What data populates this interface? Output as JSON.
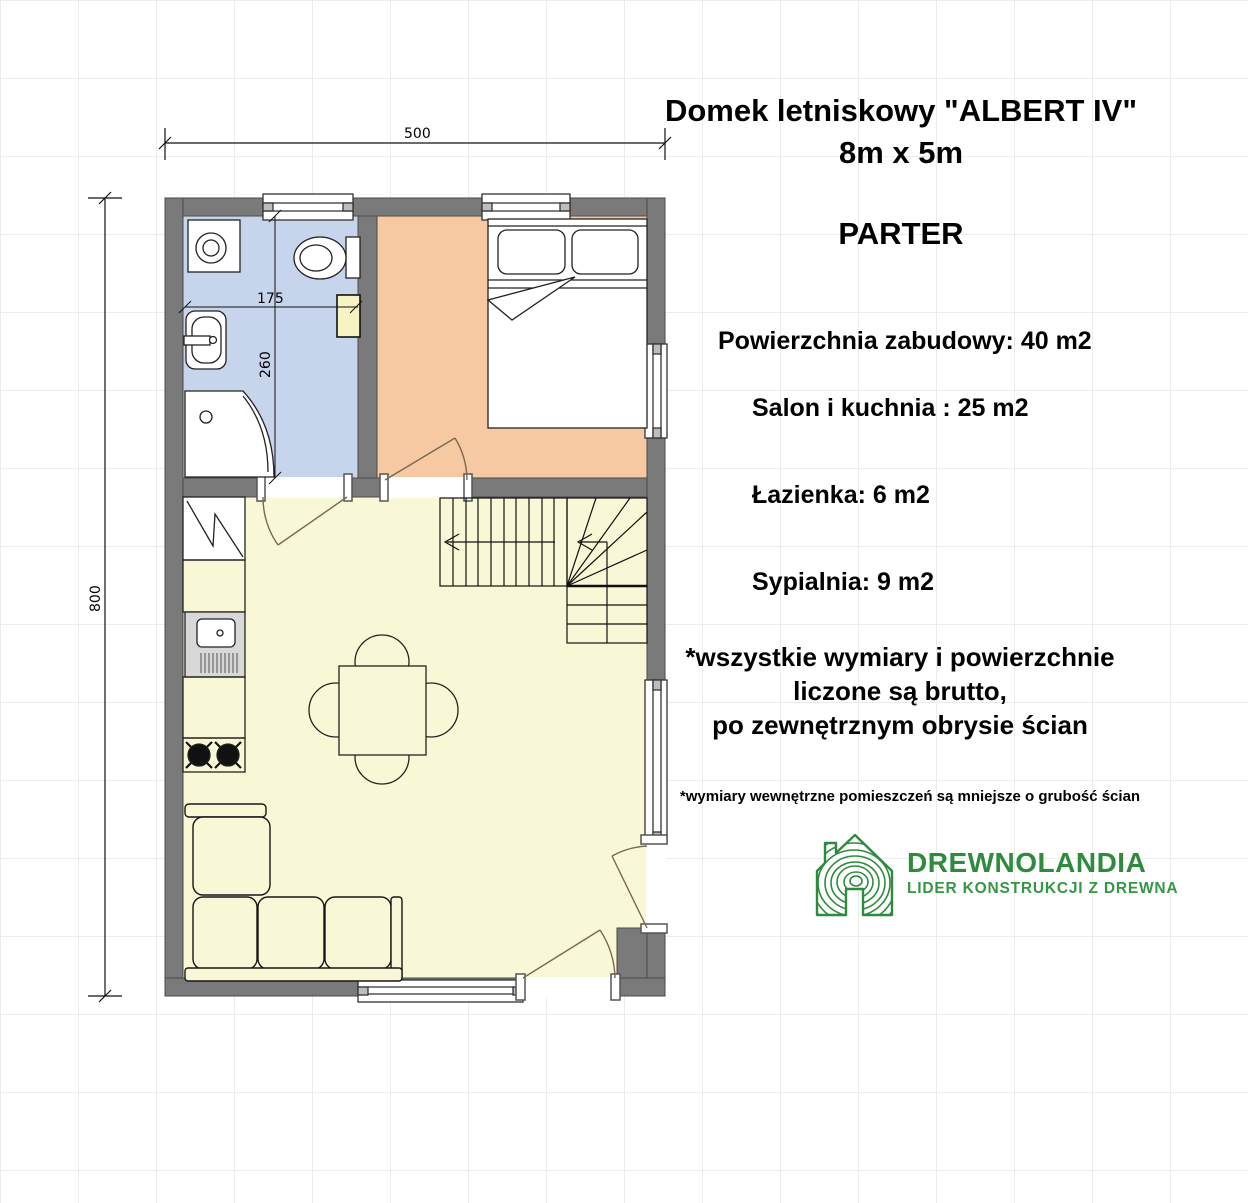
{
  "header": {
    "title_line1": "Domek letniskowy \"ALBERT IV\"",
    "title_line2": "8m x 5m",
    "floor_label": "PARTER"
  },
  "areas": {
    "total": "Powierzchnia zabudowy: 40 m2",
    "living_kitchen": "Salon i kuchnia : 25 m2",
    "bathroom": "Łazienka: 6 m2",
    "bedroom": "Sypialnia: 9 m2"
  },
  "notes": {
    "gross_line1": "*wszystkie wymiary i powierzchnie",
    "gross_line2": "liczone są brutto,",
    "gross_line3": "po zewnętrznym obrysie ścian",
    "internal": "*wymiary wewnętrzne pomieszczeń są mniejsze o grubość ścian"
  },
  "dimensions": {
    "total_width_cm": "500",
    "total_height_cm": "800",
    "bathroom_width_cm": "175",
    "bathroom_height_cm": "260"
  },
  "logo": {
    "brand": "DREWNOLANDIA",
    "tagline": "LIDER KONSTRUKCJI Z DREWNA",
    "brand_color": "#2e8b3d"
  },
  "plan": {
    "colors": {
      "wall": "#7a7a7a",
      "bathroom_floor": "#c6d5ec",
      "bedroom_floor": "#f6c9a3",
      "living_floor": "#f9f8d6",
      "cabinet_yellow": "#f6f4c2",
      "sink_unit_gray": "#d8d8d8"
    }
  }
}
